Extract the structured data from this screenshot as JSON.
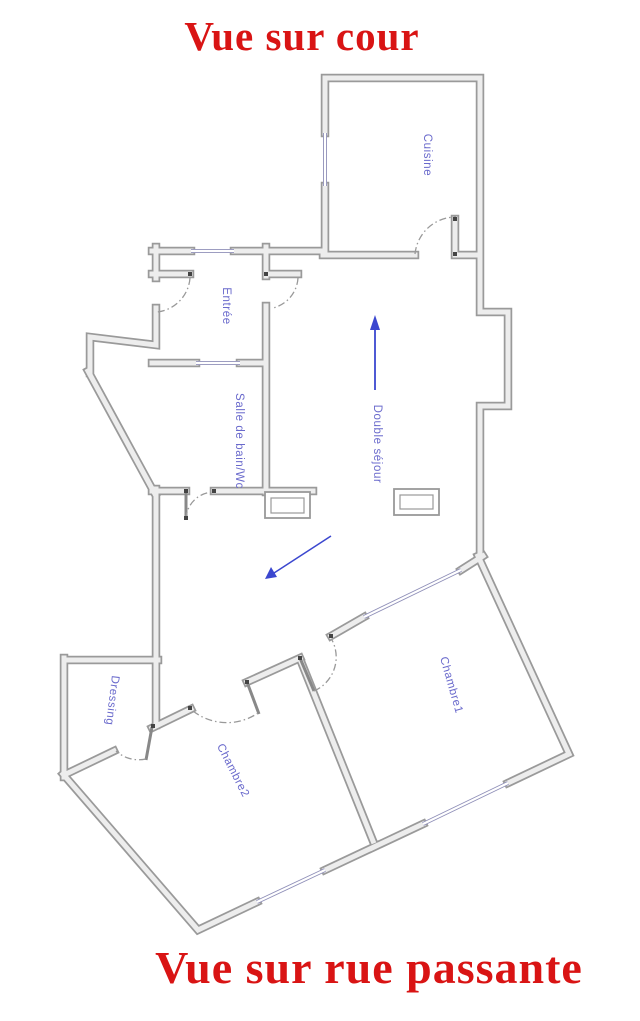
{
  "titles": {
    "top": "Vue sur cour",
    "bottom": "Vue sur rue passante"
  },
  "rooms": {
    "cuisine": {
      "label": "Cuisine"
    },
    "entree": {
      "label": "Entrée"
    },
    "salle_de_bain": {
      "label": "Salle de bain/Wc"
    },
    "double_sejour": {
      "label": "Double séjour"
    },
    "dressing": {
      "label": "Dressing"
    },
    "chambre1": {
      "label": "Chambre1"
    },
    "chambre2": {
      "label": "Chambre2"
    }
  },
  "icons": {
    "sejour_direction": "up-arrow",
    "entry_direction": "down-left-arrow"
  },
  "colors": {
    "title_red": "#d91414",
    "label_blue": "#6a6acc",
    "wall_outline": "#9a9a9a",
    "wall_fill": "#ededed",
    "window_blue_gray": "#8f8fb8",
    "door_arc_gray": "#999999",
    "arrow_blue": "#3b47cf",
    "background": "#ffffff"
  }
}
